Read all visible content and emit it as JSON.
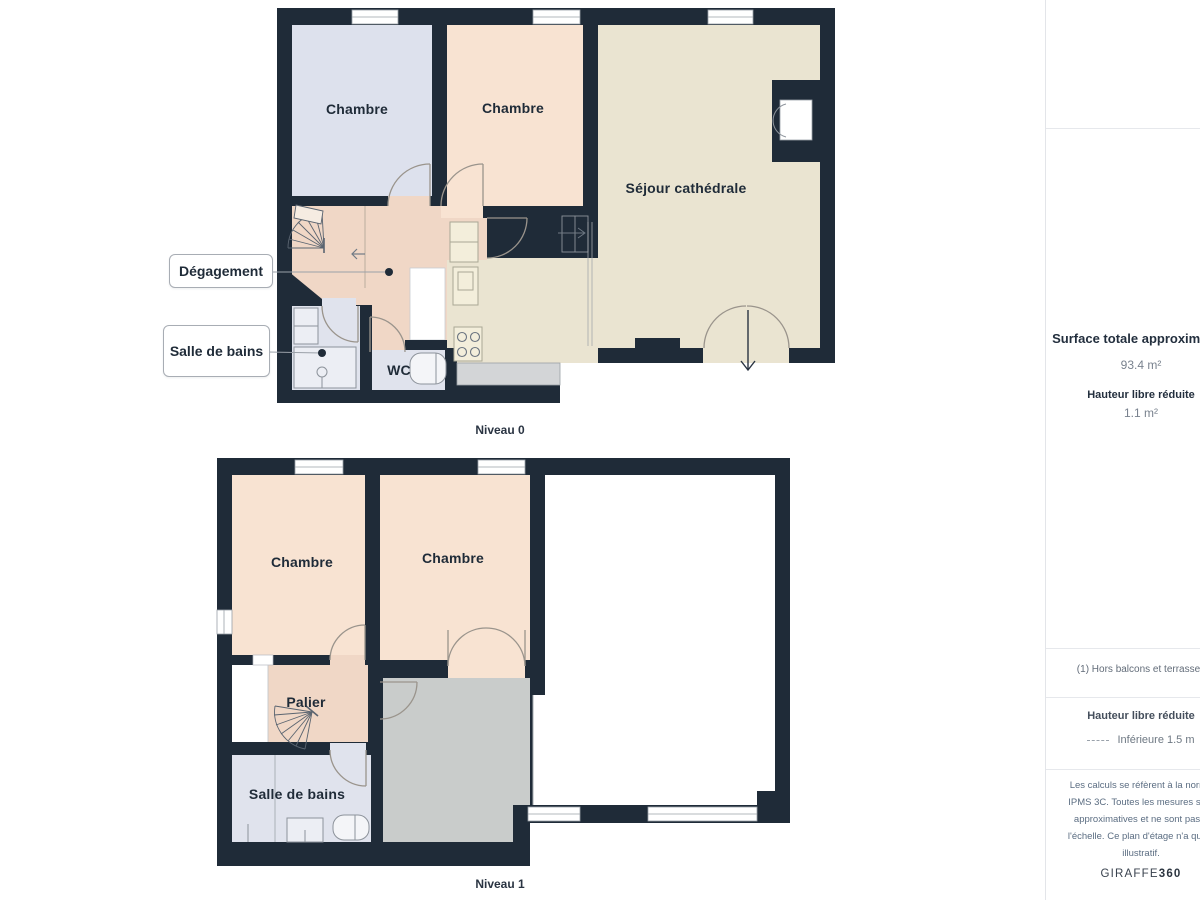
{
  "floorplan": {
    "levels": [
      {
        "caption": "Niveau 0",
        "rooms": [
          {
            "label": "Chambre"
          },
          {
            "label": "Chambre"
          },
          {
            "label": "Séjour cathédrale"
          },
          {
            "label": "WC"
          }
        ],
        "callouts": [
          {
            "label": "Dégagement"
          },
          {
            "label": "Salle de bains"
          }
        ]
      },
      {
        "caption": "Niveau 1",
        "rooms": [
          {
            "label": "Chambre"
          },
          {
            "label": "Chambre"
          },
          {
            "label": "Palier"
          },
          {
            "label": "Salle de bains"
          }
        ]
      }
    ]
  },
  "sidebar": {
    "logo_letter": "a",
    "surface_title": "Surface totale approximative",
    "surface_value": "93.4 m²",
    "height_label": "Hauteur libre réduite",
    "height_value": "1.1 m²",
    "footnote": "(1) Hors balcons et terrasses",
    "reduced_height_label": "Hauteur libre réduite",
    "reduced_height_value": "Inférieure 1.5 m",
    "disclaimer_lines": [
      "Les calculs se réfèrent à la norme",
      "IPMS 3C. Toutes les mesures sont",
      "approximatives et ne sont pas à",
      "l'échelle. Ce plan d'étage n'a qu'un",
      "illustratif."
    ],
    "brand_name": "GIRAFFE",
    "brand_suffix": "360"
  },
  "colors": {
    "wall": "#1f2b38",
    "bedroom_blue": "#dde1ed",
    "bedroom_peach": "#f8e3d2",
    "hallway_peach": "#f0d7c6",
    "living_beige": "#eae4d1",
    "bathroom_grey": "#e0e3ed",
    "reduced_height_grey": "#c9cccb",
    "counter_grey": "#d3d5d7",
    "logo_green": "#4c6a55",
    "logo_orange": "#d89a58"
  }
}
